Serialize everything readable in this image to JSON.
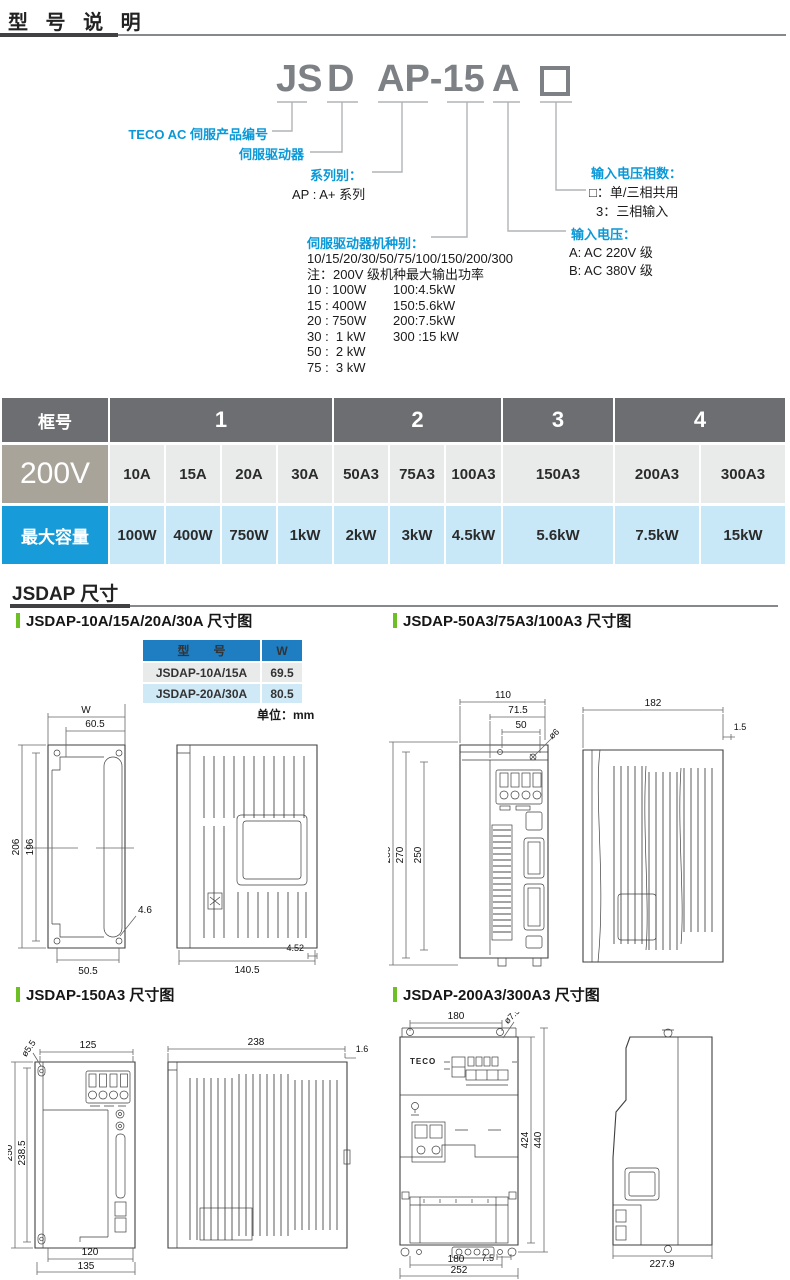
{
  "page": {
    "title": "型 号 说 明",
    "section_dimensions_title": "JSDAP 尺寸"
  },
  "model_diagram": {
    "part1": "JS",
    "part2": "D",
    "part3": "AP-15",
    "part4": "A",
    "product_no_label": "TECO AC 伺服产品编号",
    "servo_drive_label": "伺服驱动器",
    "series_label": "系列别：",
    "series_value": "AP : A+ 系列",
    "type_label": "伺服驱动器机种别：",
    "type_codes": "10/15/20/30/50/75/100/150/200/300",
    "type_note": "注：200V 级机种最大输出功率",
    "type_rows": [
      {
        "c1": "10 : 100W",
        "c2": "100:4.5kW"
      },
      {
        "c1": "15 : 400W",
        "c2": "150:5.6kW"
      },
      {
        "c1": "20 : 750W",
        "c2": "200:7.5kW"
      },
      {
        "c1": "30 :  1 kW",
        "c2": "300 :15 kW"
      },
      {
        "c1": "50 :  2 kW",
        "c2": ""
      },
      {
        "c1": "75 :  3 kW",
        "c2": ""
      }
    ],
    "phase_label": "输入电压相数：",
    "phase_option1": "□：单/三相共用",
    "phase_option2": "3：三相输入",
    "voltage_label": "输入电压：",
    "voltage_option1": "A: AC 220V 级",
    "voltage_option2": "B: AC 380V 级"
  },
  "capacity_table": {
    "frame_label": "框号",
    "frame_groups": [
      {
        "label": "1"
      },
      {
        "label": "2"
      },
      {
        "label": "3"
      },
      {
        "label": "4"
      }
    ],
    "voltage_label": "200V",
    "models": [
      "10A",
      "15A",
      "20A",
      "30A",
      "50A3",
      "75A3",
      "100A3",
      "150A3",
      "200A3",
      "300A3"
    ],
    "capacity_label": "最大容量",
    "capacities": [
      "100W",
      "400W",
      "750W",
      "1kW",
      "2kW",
      "3kW",
      "4.5kW",
      "5.6kW",
      "7.5kW",
      "15kW"
    ]
  },
  "drawing1": {
    "heading": "JSDAP-10A/15A/20A/30A 尺寸图",
    "table": {
      "col_model": "型　　号",
      "col_w": "W",
      "rows": [
        {
          "model": "JSDAP-10A/15A",
          "w": "69.5"
        },
        {
          "model": "JSDAP-20A/30A",
          "w": "80.5"
        }
      ],
      "unit": "单位：mm"
    },
    "dims": {
      "w": "W",
      "top": "60.5",
      "h1": "206",
      "h2": "196",
      "hole": "4.6",
      "bottom": "50.5",
      "depth": "140.5",
      "t": "4.52"
    }
  },
  "drawing2": {
    "heading": "JSDAP-50A3/75A3/100A3 尺寸图",
    "dims": {
      "w1": "110",
      "w2": "71.5",
      "w3": "50",
      "hole": "ø6",
      "h1": "286",
      "h2": "270",
      "h3": "250",
      "depth": "182",
      "t": "1.5"
    }
  },
  "drawing3": {
    "heading": "JSDAP-150A3 尺寸图",
    "dims": {
      "hole": "ø5.5",
      "top": "125",
      "h1": "250",
      "h2": "238.5",
      "b1": "120",
      "b2": "135",
      "depth": "238",
      "t": "1.6"
    }
  },
  "drawing4": {
    "heading": "JSDAP-200A3/300A3 尺寸图",
    "logo": "TECO",
    "dims": {
      "top": "180",
      "hole": "ø7.5",
      "h1": "424",
      "h2": "440",
      "b0": "7.5",
      "b1": "180",
      "b2": "252",
      "depth": "227.9"
    }
  }
}
